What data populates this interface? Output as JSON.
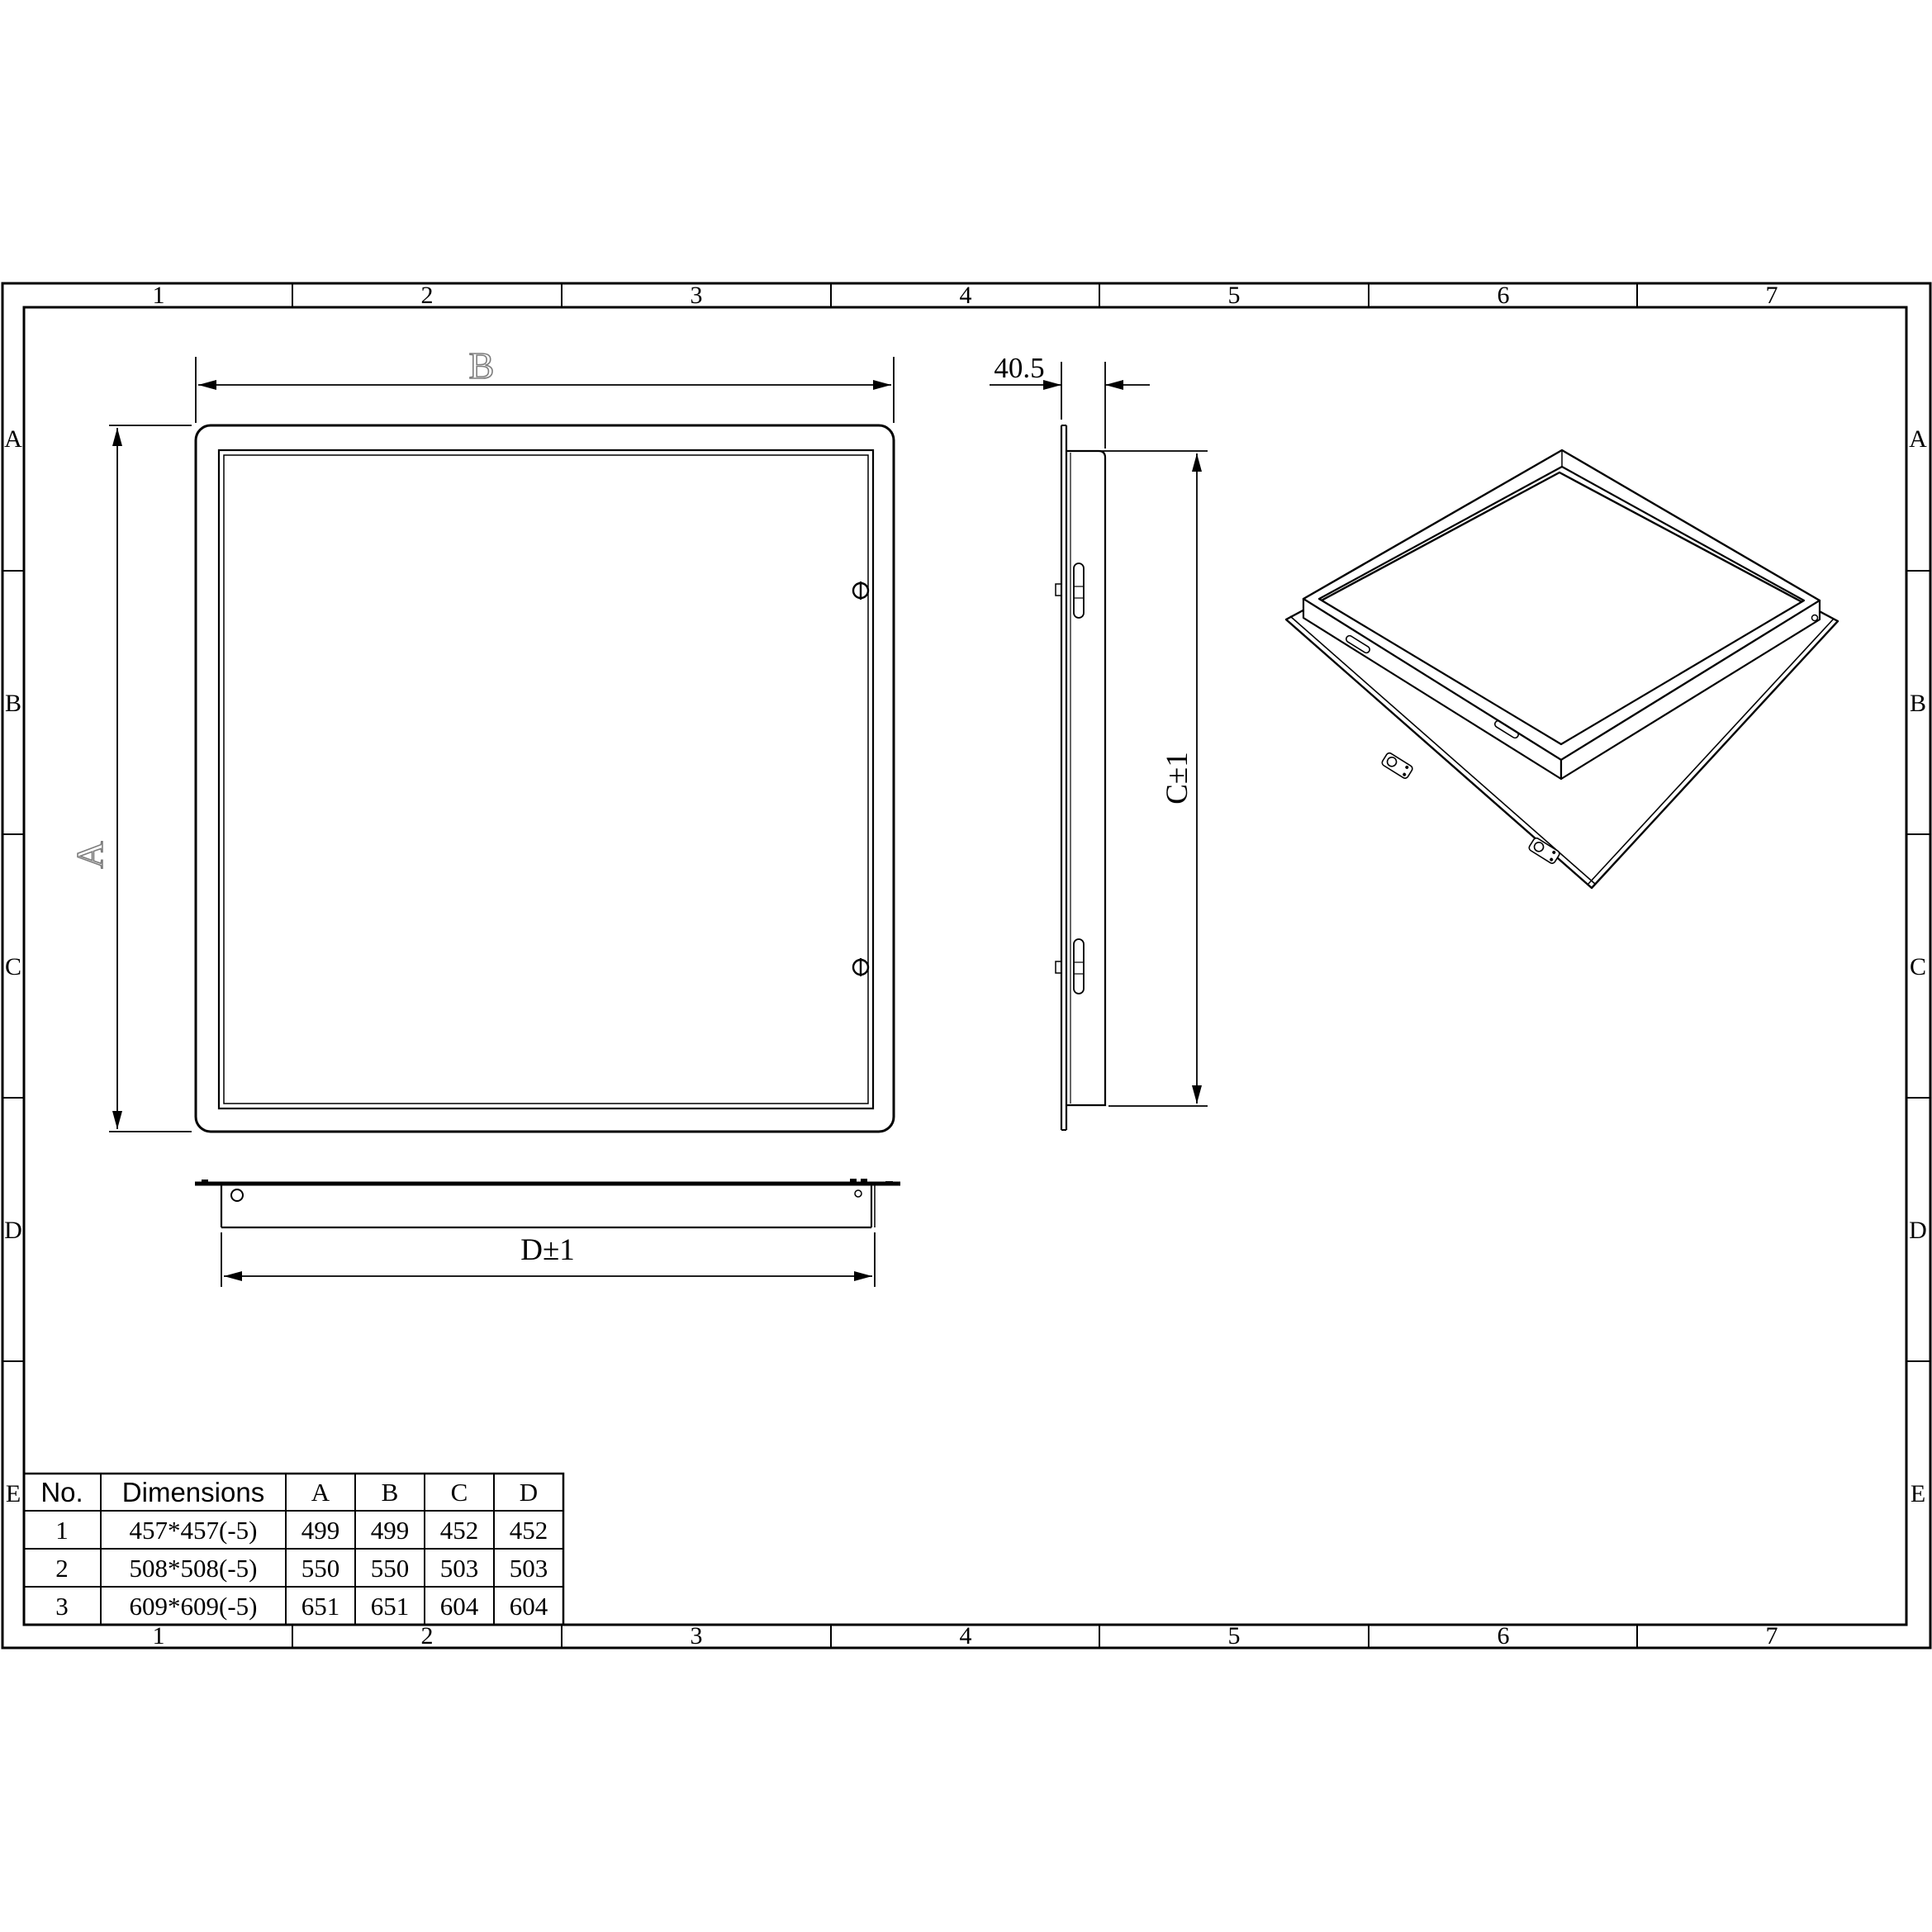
{
  "drawing": {
    "grid": {
      "columns": [
        "1",
        "2",
        "3",
        "4",
        "5",
        "6",
        "7"
      ],
      "rows": [
        "A",
        "B",
        "C",
        "D",
        "E"
      ]
    },
    "dimension_labels": {
      "front_width": "B",
      "front_height": "A",
      "side_depth": "40.5",
      "side_height": "C±1",
      "bottom_width": "D±1"
    },
    "table": {
      "headers": {
        "no": "No.",
        "dimensions": "Dimensions",
        "a": "A",
        "b": "B",
        "c": "C",
        "d": "D"
      },
      "rows": [
        {
          "no": "1",
          "dimensions": "457*457(-5)",
          "a": "499",
          "b": "499",
          "c": "452",
          "d": "452"
        },
        {
          "no": "2",
          "dimensions": "508*508(-5)",
          "a": "550",
          "b": "550",
          "c": "503",
          "d": "503"
        },
        {
          "no": "3",
          "dimensions": "609*609(-5)",
          "a": "651",
          "b": "651",
          "c": "604",
          "d": "604"
        }
      ]
    },
    "colors": {
      "line": "#000000",
      "outline_label": "#7d7d7d",
      "background": "#ffffff"
    }
  }
}
